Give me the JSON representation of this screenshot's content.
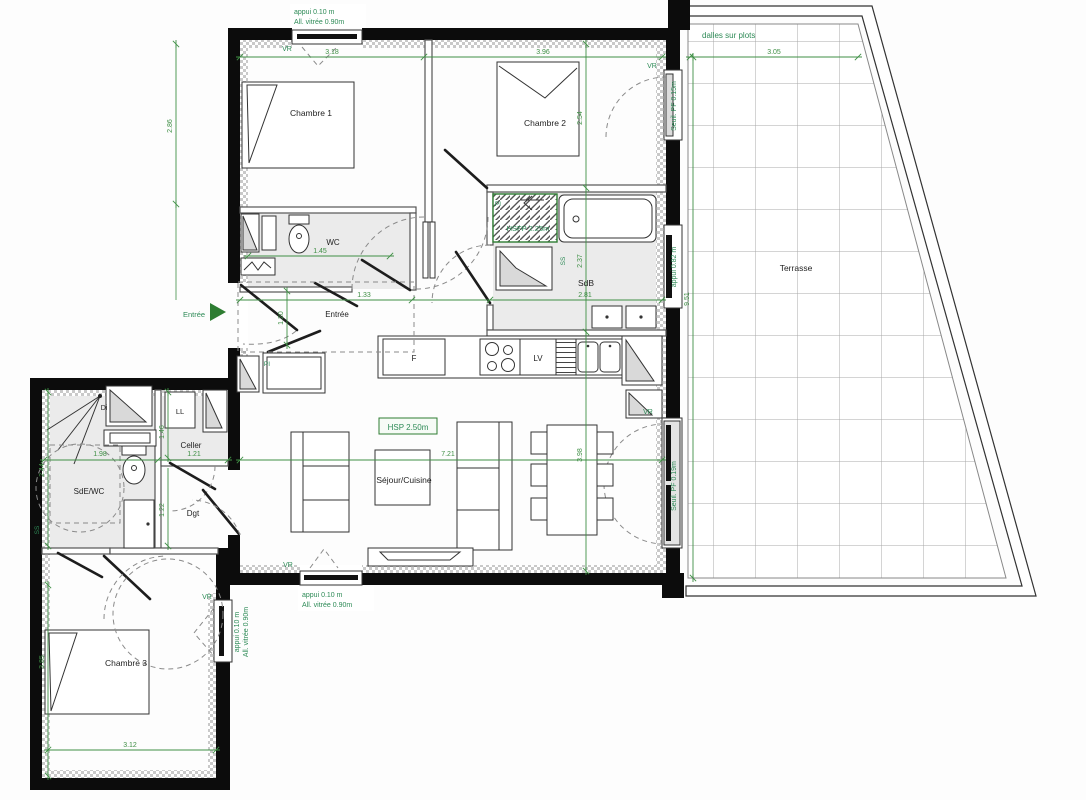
{
  "title": "Plan d'appartement T4 avec terrasse",
  "rooms": {
    "chambre1": "Chambre 1",
    "chambre2": "Chambre 2",
    "chambre3": "Chambre 3",
    "wc": "WC",
    "sdb": "SdB",
    "sde_wc": "SdE/WC",
    "celler": "Celler",
    "dgt": "Dgt",
    "sejour": "Séjour/Cuisine",
    "entree": "Entrée",
    "terrasse": "Terrasse"
  },
  "appliances": {
    "fridge": "F",
    "dishwasher": "LV",
    "washing_machine": "LL",
    "di": "Di"
  },
  "annotations": {
    "entree_arrow": "Entrée",
    "vr": "VR",
    "dalles": "dalles sur plots",
    "seuil_pf_015": "Seuil. PF 0.15m",
    "seuil_pf_019": "Seuil. PF 0.19m",
    "appui_082": "appui 0.82 m",
    "appui_010": "appui 0.10 m",
    "allege_090": "All. vitrée 0.90m",
    "hsp": "HSP 2.50m",
    "hsfp": "HSFP 2.25m",
    "pi": "PI",
    "ss": "SS"
  },
  "dimensions": {
    "chambre1_w": "3.18",
    "chambre2_w": "3.96",
    "terrasse_w": "3.05",
    "chambre1_h": "2.86",
    "chambre2_h": "2.54",
    "terrasse_h": "9.51",
    "wc_w": "1.45",
    "hall_w": "1.33",
    "sdb_w": "2.81",
    "sdb_h": "2.37",
    "entree_h": "1.20",
    "sde_w": "1.98",
    "sde_h": "2.44",
    "celler_h": "1.46",
    "celler_w": "1.21",
    "sejour_w": "7.21",
    "sejour_h": "3.98",
    "dgt_h": "1.22",
    "chambre3_h": "3.85",
    "chambre3_w": "3.12"
  }
}
